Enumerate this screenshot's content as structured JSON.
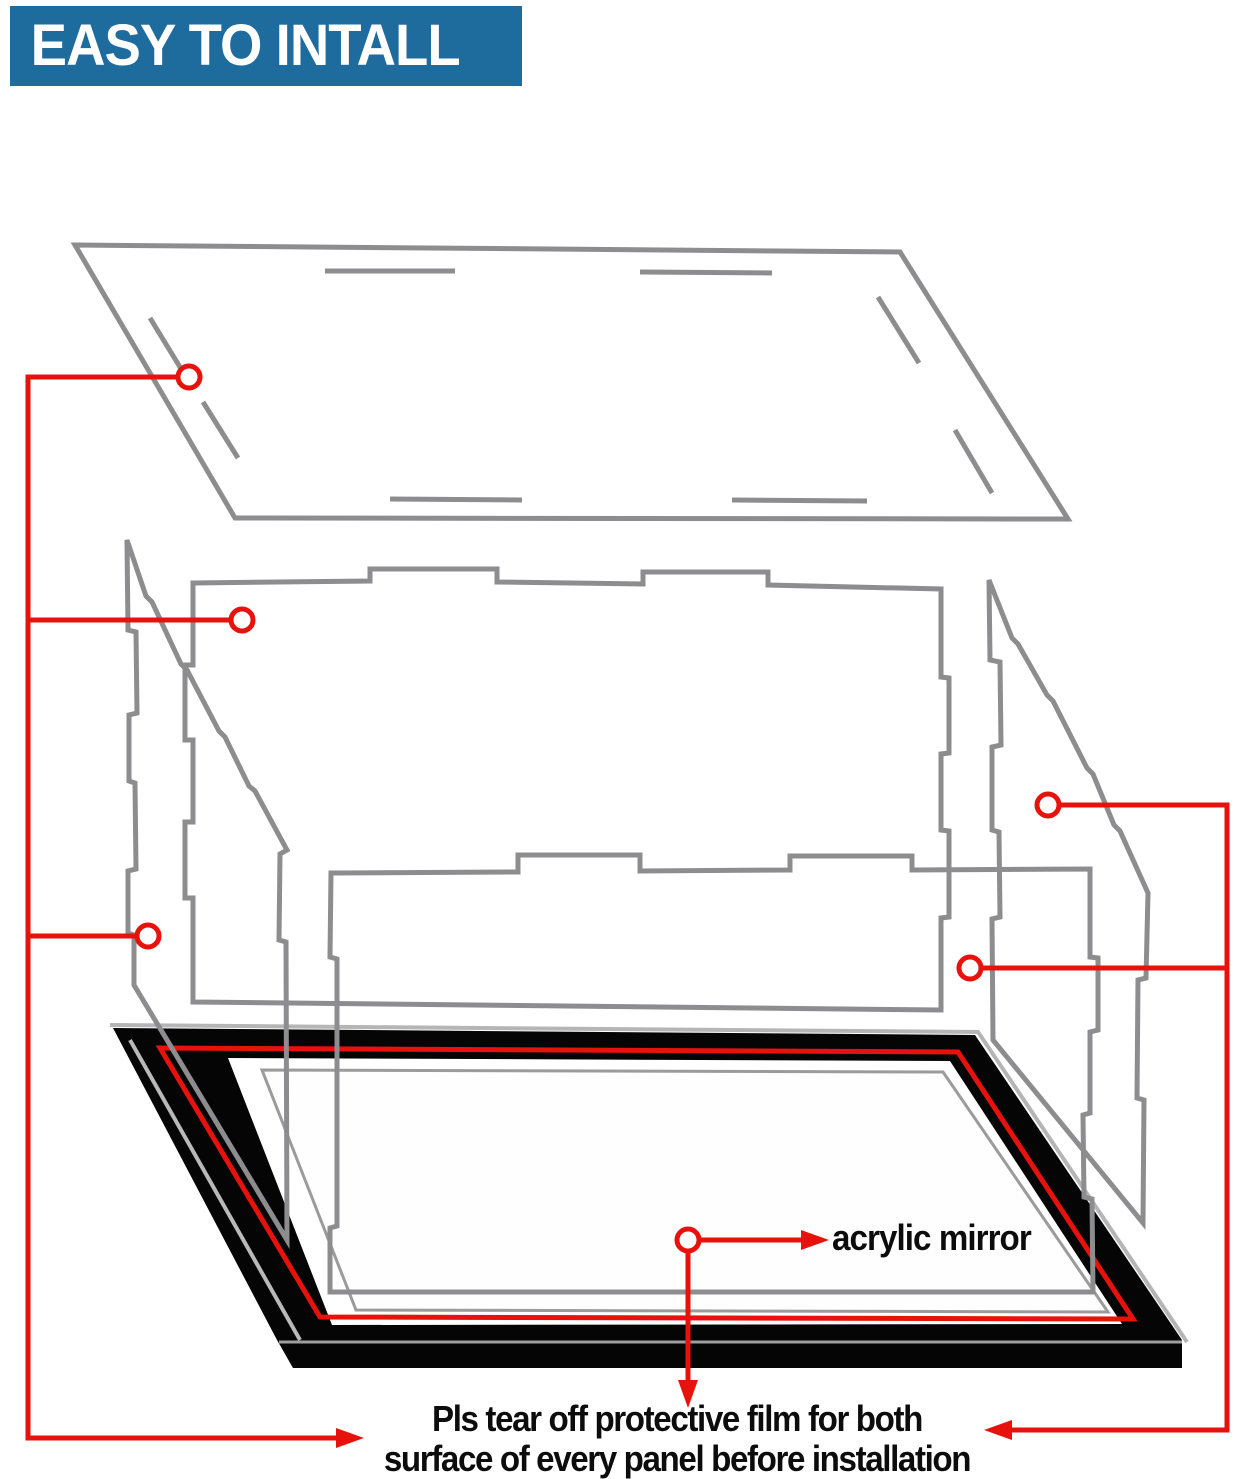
{
  "header": {
    "title": "EASY TO INTALL",
    "bg_color": "#1e6b9e",
    "text_color": "#ffffff"
  },
  "labels": {
    "acrylic_mirror": "acrylic mirror"
  },
  "instructions": {
    "line1": "Pls tear off protective film for both",
    "line2": "surface of every panel before installation"
  },
  "colors": {
    "annotation_red": "#e8120c",
    "panel_outline_gray": "#8d8d8f",
    "base_black": "#050505",
    "base_highlight_gray": "#b9b9b9",
    "mirror_outline_gray": "#9b9b9b"
  },
  "diagram": {
    "type": "exploded-assembly-instruction",
    "parts": [
      "top-lid-panel",
      "back-panel",
      "left-side-panel",
      "right-side-panel",
      "front-panel",
      "mirror-base"
    ],
    "callouts": [
      {
        "target": "top-lid-panel",
        "marker": "circle",
        "connects_to": "instruction-text"
      },
      {
        "target": "back-panel",
        "marker": "circle",
        "connects_to": "instruction-text"
      },
      {
        "target": "left-side-panel",
        "marker": "circle",
        "connects_to": "instruction-text"
      },
      {
        "target": "right-side-panel",
        "marker": "circle",
        "connects_to": "instruction-text"
      },
      {
        "target": "right-front-corner-panel",
        "marker": "circle",
        "connects_to": "instruction-text"
      },
      {
        "target": "mirror-base",
        "marker": "circle",
        "connects_to": "acrylic-mirror-label"
      }
    ]
  }
}
